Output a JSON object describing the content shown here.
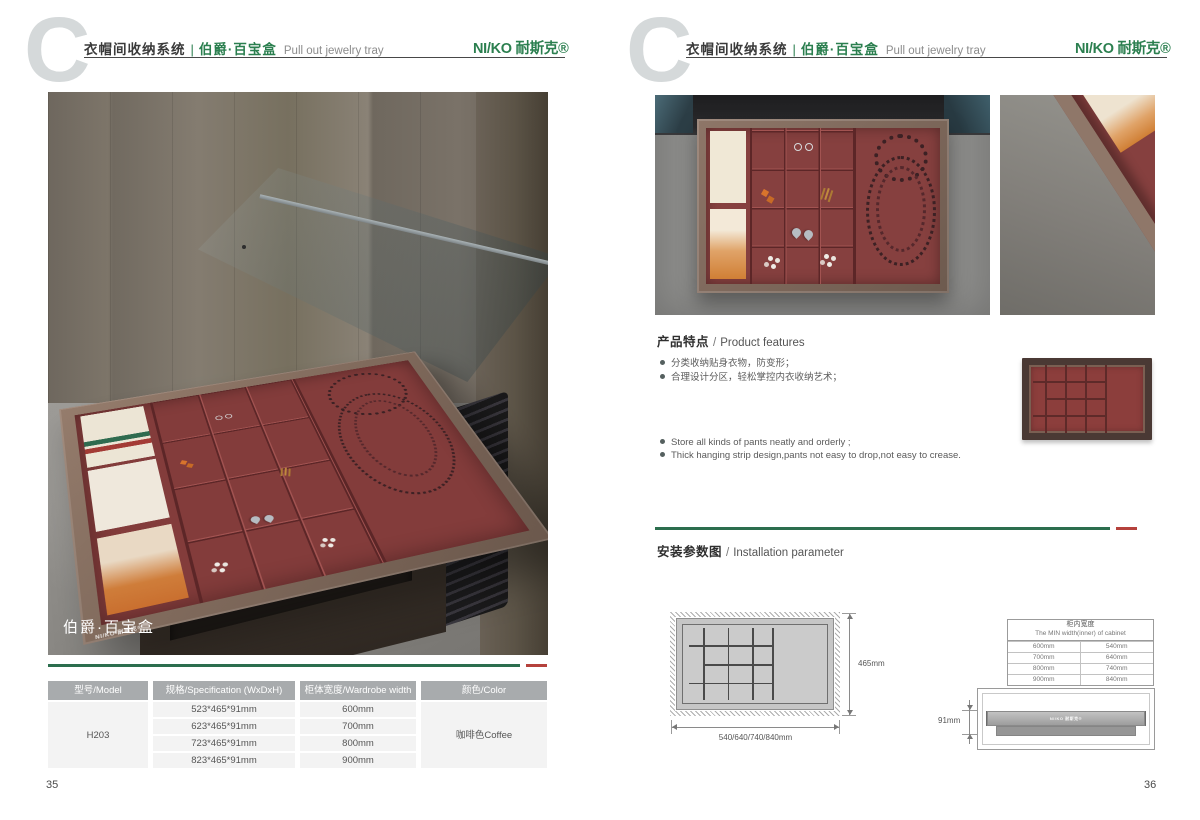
{
  "header": {
    "letter_mark": "C",
    "category": "衣帽间收纳系统",
    "separator": "|",
    "product_cn": "伯爵·百宝盒",
    "product_en": "Pull out jewelry tray",
    "logo": "NI/KO 耐斯克®"
  },
  "left_page": {
    "page_number": "35",
    "photo_caption": "伯爵·百宝盒",
    "spec_table": {
      "headers": [
        "型号/Model",
        "规格/Specification (WxDxH)",
        "柜体宽度/Wardrobe width",
        "颜色/Color"
      ],
      "model": "H203",
      "rows": [
        {
          "spec": "523*465*91mm",
          "width": "600mm"
        },
        {
          "spec": "623*465*91mm",
          "width": "700mm"
        },
        {
          "spec": "723*465*91mm",
          "width": "800mm"
        },
        {
          "spec": "823*465*91mm",
          "width": "900mm"
        }
      ],
      "color": "咖啡色Coffee"
    }
  },
  "right_page": {
    "page_number": "36",
    "features": {
      "title_cn": "产品特点",
      "title_sep": "/",
      "title_en": "Product features",
      "bullets_cn": [
        "分类收纳贴身衣物，防变形；",
        "合理设计分区，轻松掌控内衣收纳艺术；"
      ],
      "bullets_en": [
        "Store all kinds of pants neatly and orderly ;",
        "Thick hanging strip design,pants not easy to drop,not easy to crease."
      ]
    },
    "installation": {
      "title_cn": "安装参数图",
      "title_sep": "/",
      "title_en": "Installation parameter",
      "top_view": {
        "depth_label": "465mm",
        "width_label": "540/640/740/840mm"
      },
      "width_table": {
        "title_cn": "柜内宽度",
        "title_en": "The MIN width(inner) of cabinet",
        "rows": [
          [
            "600mm",
            "540mm"
          ],
          [
            "700mm",
            "640mm"
          ],
          [
            "800mm",
            "740mm"
          ],
          [
            "900mm",
            "840mm"
          ]
        ]
      },
      "side_view": {
        "height_label": "91mm"
      }
    }
  },
  "colors": {
    "brand_green": "#2b7f4f",
    "line_green": "#2c6e4e",
    "accent_red": "#b5413c",
    "table_header_gray": "#a8abad",
    "tray_maroon": "#87403f"
  }
}
